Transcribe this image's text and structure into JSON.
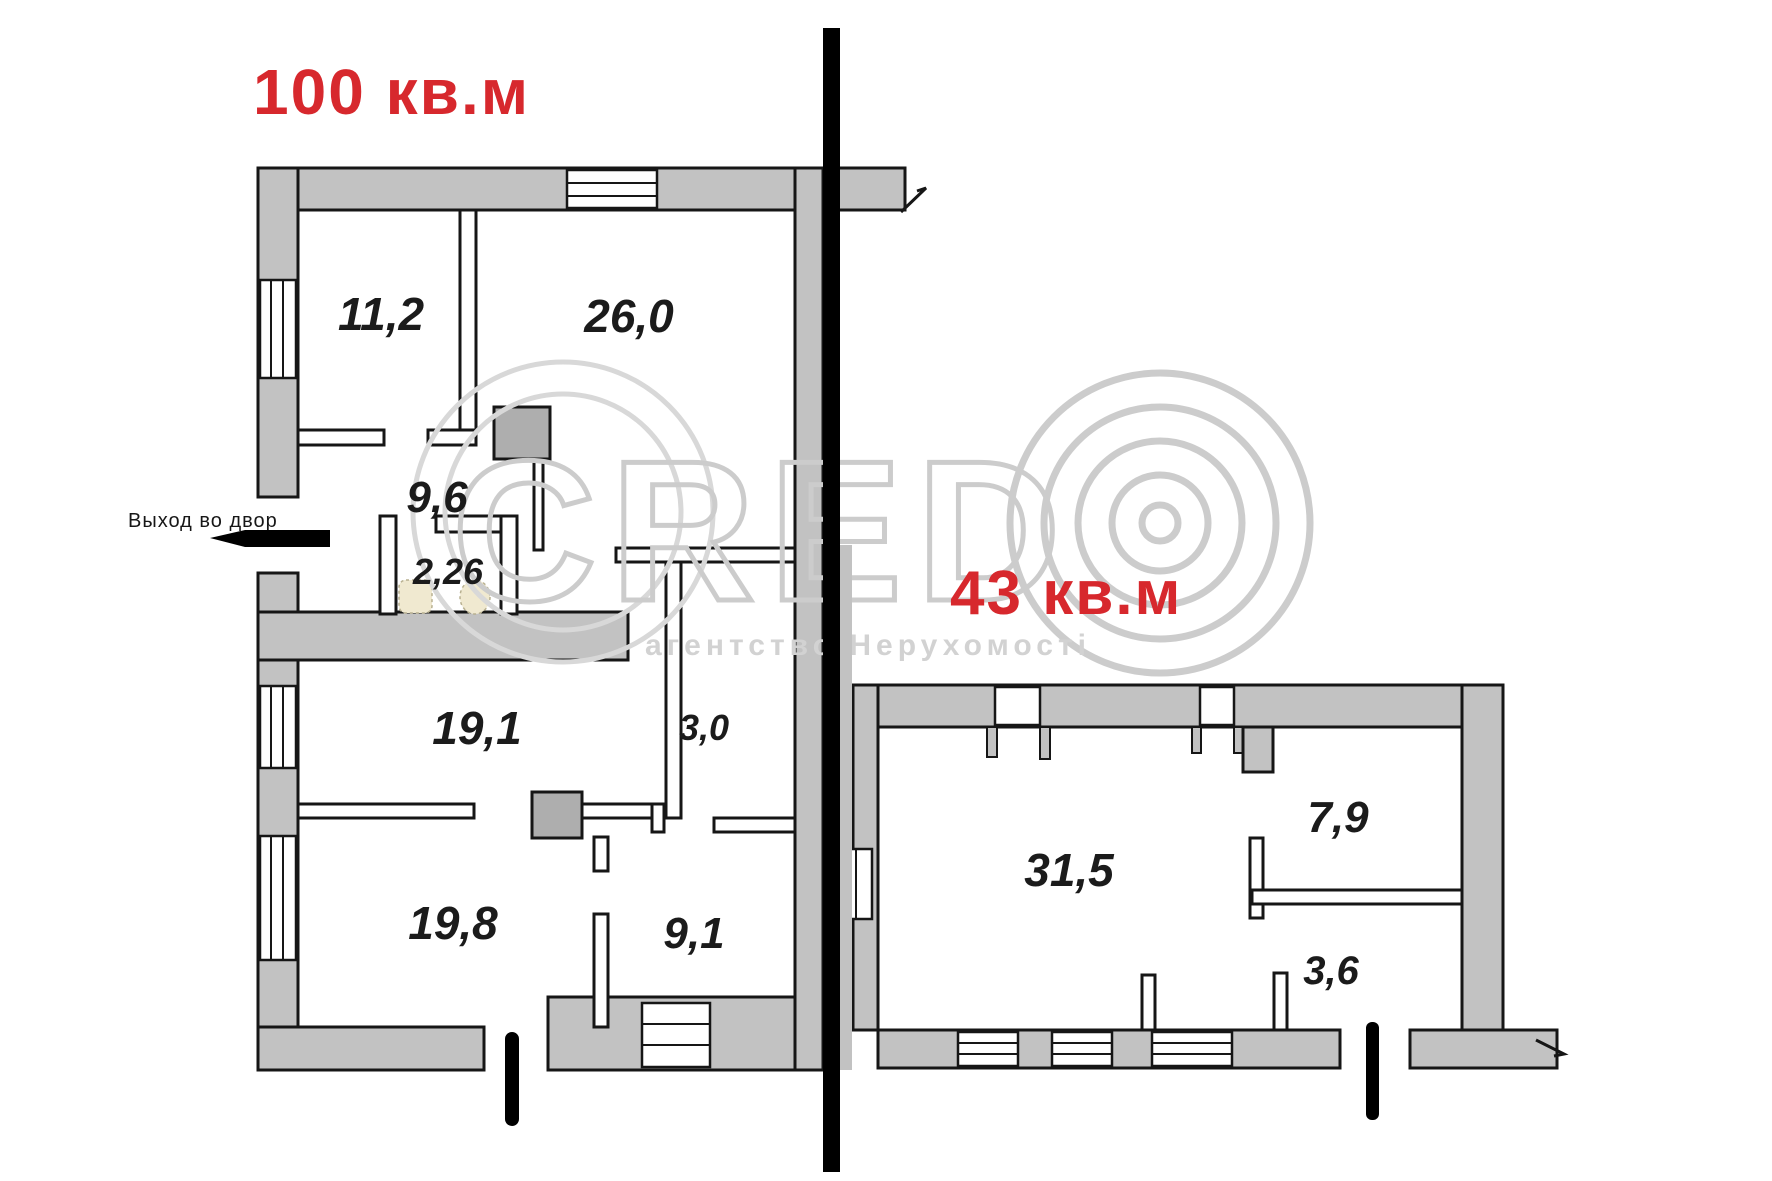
{
  "titles": {
    "left_apartment_area": "100 кв.м",
    "right_apartment_area": "43 кв.м"
  },
  "annotations": {
    "exit_to_yard": "Выход во двор"
  },
  "watermark": {
    "brand": "CRED",
    "logo": "concentric-circles-O",
    "subtitle": "агентство Нерухомості"
  },
  "rooms": {
    "left": [
      {
        "name": "room-11-2",
        "area": "11,2"
      },
      {
        "name": "room-26-0",
        "area": "26,0"
      },
      {
        "name": "hall-9-6",
        "area": "9,6"
      },
      {
        "name": "wc-2-26",
        "area": "2,26"
      },
      {
        "name": "room-19-1",
        "area": "19,1"
      },
      {
        "name": "hall-3-0",
        "area": "3,0"
      },
      {
        "name": "room-19-8",
        "area": "19,8"
      },
      {
        "name": "room-9-1",
        "area": "9,1"
      }
    ],
    "right": [
      {
        "name": "room-31-5",
        "area": "31,5"
      },
      {
        "name": "room-7-9",
        "area": "7,9"
      },
      {
        "name": "room-3-6",
        "area": "3,6"
      }
    ]
  },
  "colors": {
    "area_title": "#d7282d",
    "wall_fill": "#c2c2c2",
    "wall_stroke": "#161616",
    "watermark": "#cccccc",
    "fixture": "#f0e9d0"
  }
}
